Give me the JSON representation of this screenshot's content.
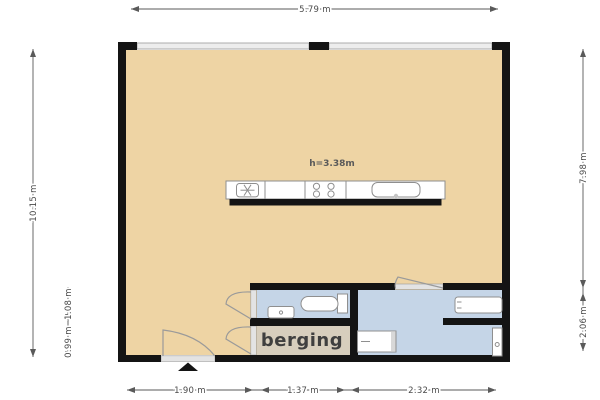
{
  "plan": {
    "dimensions": {
      "top_width": "5.79 m",
      "left_height": "10.15 m",
      "left_inner_upper": "1.08 m",
      "left_inner_lower": "0.99 m",
      "right_upper": "7.98 m",
      "right_lower": "2.06 m",
      "bottom_left": "1.90 m",
      "bottom_middle": "1.37 m",
      "bottom_right": "2.32 m"
    },
    "labels": {
      "ceiling_height": "h=3.38m",
      "storage_room": "berging"
    },
    "colors": {
      "floor_main": "#eed4a4",
      "floor_wet": "#c5d5e7",
      "floor_storage": "#d7cebd",
      "wall": "#141414",
      "fixture_stroke": "#8f8f8f",
      "dim": "#4a4a4a"
    },
    "icons": {
      "kitchen_unit": "extractor-fan-icon",
      "cooktop": "burners-icon",
      "sink": "sink-icon",
      "toilet": "toilet-icon",
      "hand_basin": "hand-basin-icon",
      "washer": "washing-machine-icon",
      "bath_counter": "washbasin-icon",
      "shower": "shower-icon",
      "entrance_marker": "entrance-arrow-icon"
    }
  }
}
